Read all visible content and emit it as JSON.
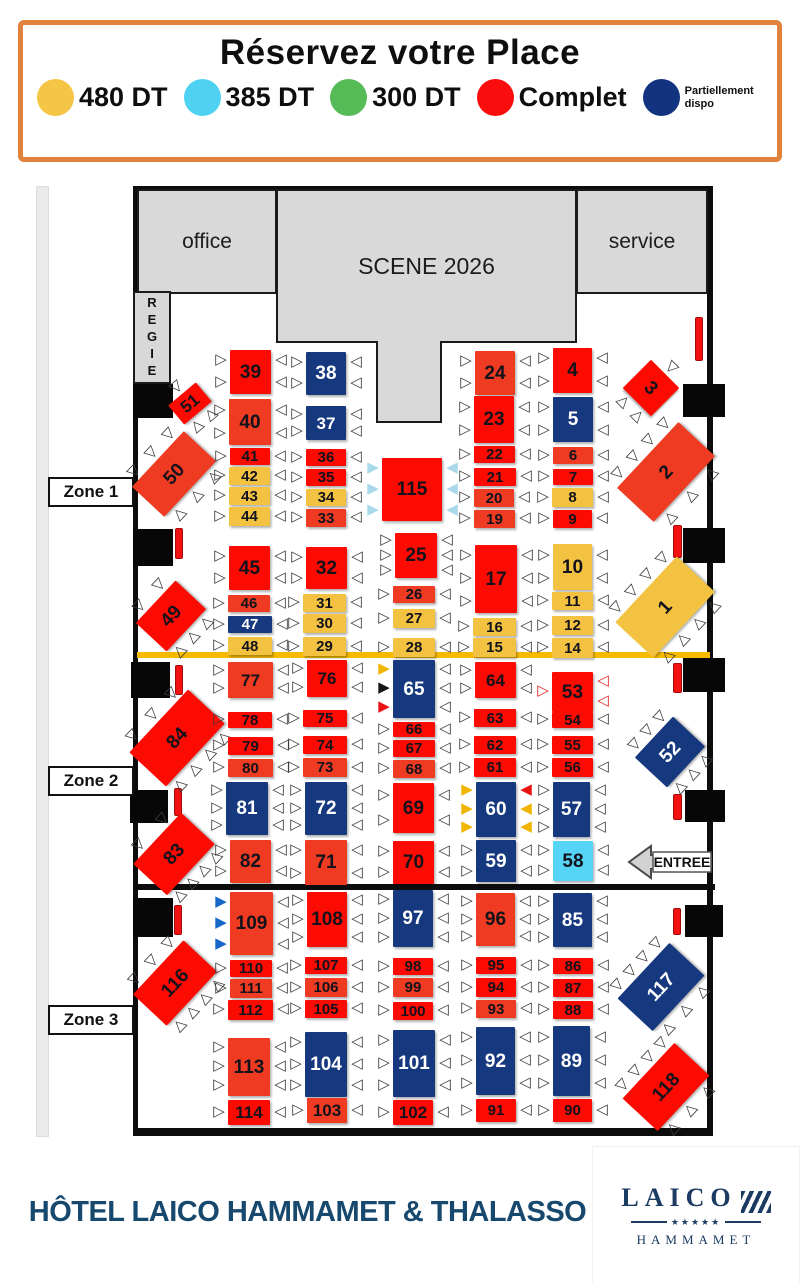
{
  "header": {
    "title": "Réservez votre Place",
    "legend": [
      {
        "name": "price-480",
        "label": "480 DT",
        "color": "#f5c546"
      },
      {
        "name": "price-385",
        "label": "385 DT",
        "color": "#4fd2f2"
      },
      {
        "name": "price-300",
        "label": "300 DT",
        "color": "#54bb57"
      },
      {
        "name": "complet",
        "label": "Complet",
        "color": "#fb0d0d"
      },
      {
        "name": "partiellement-dispo",
        "label": "Partiellement dispo",
        "color": "#12337f",
        "small": true
      }
    ]
  },
  "venue": {
    "office": "office",
    "scene": "SCENE 2026",
    "service": "service",
    "regie": "REGIE",
    "entree": "ENTREE"
  },
  "zones": [
    {
      "label": "Zone 1",
      "x": 48,
      "y": 477
    },
    {
      "label": "Zone 2",
      "x": 48,
      "y": 766
    },
    {
      "label": "Zone 3",
      "x": 48,
      "y": 1005
    }
  ],
  "palette": {
    "R": "#fb0b02",
    "O": "#ee3b21",
    "Y": "#f2c240",
    "B": "#16387f",
    "C": "#55d4f5",
    "chair_outline": "#3c3c3c",
    "chair_red_outline": "#e32222",
    "chair_cyan": "#a9d8ea",
    "chair_yellow": "#f1b400",
    "chair_black": "#161616",
    "chair_red": "#ea1313",
    "chair_blue": "#1767c9",
    "separator_yellow": "#f6bb00",
    "separator_black": "#0d0d0d"
  },
  "structure": {
    "blocks": [
      [
        133,
        384,
        40,
        34
      ],
      [
        133,
        529,
        40,
        37
      ],
      [
        131,
        662,
        39,
        36
      ],
      [
        130,
        790,
        38,
        33
      ],
      [
        133,
        898,
        40,
        39
      ],
      [
        683,
        384,
        42,
        33
      ],
      [
        683,
        528,
        42,
        35
      ],
      [
        683,
        658,
        42,
        34
      ],
      [
        685,
        790,
        40,
        32
      ],
      [
        685,
        905,
        38,
        32
      ]
    ],
    "bars": [
      [
        175,
        528,
        8,
        31
      ],
      [
        175,
        665,
        8,
        30
      ],
      [
        174,
        788,
        8,
        28
      ],
      [
        174,
        905,
        8,
        30
      ],
      [
        695,
        317,
        8,
        44
      ],
      [
        673,
        525,
        9,
        33
      ],
      [
        673,
        663,
        9,
        30
      ],
      [
        673,
        794,
        9,
        26
      ],
      [
        673,
        908,
        8,
        27
      ]
    ],
    "lines": [
      {
        "x": 137,
        "y": 652,
        "w": 573,
        "h": 6,
        "color": "#f6bb00",
        "name": "zone1-2-separator"
      },
      {
        "x": 137,
        "y": 884,
        "w": 578,
        "h": 6,
        "color": "#0d0d0d",
        "name": "zone2-3-separator"
      }
    ]
  },
  "tables": [
    [
      "39",
      230,
      350,
      41,
      44,
      "R",
      "ww",
      "ww",
      0
    ],
    [
      "38",
      306,
      352,
      40,
      43,
      "B",
      "ww",
      "ww",
      0
    ],
    [
      "51",
      172,
      391,
      36,
      25,
      "R",
      "w",
      "ww",
      -40
    ],
    [
      "40",
      229,
      399,
      42,
      46,
      "O",
      "ww",
      "ww",
      0
    ],
    [
      "37",
      306,
      406,
      40,
      34,
      "B",
      "ww",
      "ww",
      0
    ],
    [
      "50",
      136,
      452,
      76,
      44,
      "O",
      "www",
      "www",
      -47
    ],
    [
      "41",
      230,
      448,
      40,
      17,
      "R",
      "w",
      "w",
      0
    ],
    [
      "36",
      306,
      449,
      40,
      17,
      "R",
      "w",
      "w",
      0
    ],
    [
      "42",
      229,
      467,
      41,
      18,
      "Y",
      "w",
      "w",
      0
    ],
    [
      "35",
      306,
      469,
      40,
      17,
      "R",
      "w",
      "w",
      0
    ],
    [
      "43",
      229,
      487,
      41,
      18,
      "Y",
      "w",
      "w",
      0
    ],
    [
      "34",
      306,
      489,
      40,
      17,
      "Y",
      "w",
      "w",
      0
    ],
    [
      "44",
      229,
      507,
      41,
      19,
      "Y",
      "w",
      "w",
      0
    ],
    [
      "33",
      306,
      509,
      40,
      18,
      "O",
      "w",
      "w",
      0
    ],
    [
      "115",
      382,
      458,
      60,
      63,
      "R",
      "ccc",
      "ccc",
      0
    ],
    [
      "24",
      475,
      351,
      40,
      44,
      "O",
      "ww",
      "ww",
      0
    ],
    [
      "4",
      553,
      348,
      39,
      45,
      "R",
      "ww",
      "ww",
      0
    ],
    [
      "23",
      474,
      396,
      40,
      47,
      "R",
      "ww",
      "ww",
      0
    ],
    [
      "5",
      553,
      397,
      40,
      45,
      "B",
      "ww",
      "ww",
      0
    ],
    [
      "3",
      631,
      368,
      40,
      40,
      "R",
      "w",
      "ww",
      45
    ],
    [
      "22",
      474,
      446,
      41,
      17,
      "R",
      "w",
      "w",
      0
    ],
    [
      "6",
      553,
      447,
      40,
      17,
      "O",
      "w",
      "w",
      0
    ],
    [
      "21",
      474,
      468,
      42,
      18,
      "R",
      "w",
      "w",
      0
    ],
    [
      "7",
      553,
      469,
      40,
      16,
      "R",
      "w",
      "w",
      0
    ],
    [
      "20",
      474,
      489,
      40,
      18,
      "O",
      "w",
      "w",
      0
    ],
    [
      "8",
      552,
      488,
      41,
      19,
      "Y",
      "w",
      "w",
      0
    ],
    [
      "19",
      474,
      510,
      41,
      18,
      "O",
      "w",
      "w",
      0
    ],
    [
      "9",
      553,
      510,
      39,
      18,
      "R",
      "w",
      "w",
      0
    ],
    [
      "2",
      621,
      447,
      90,
      50,
      "O",
      "wwww",
      "www",
      -47
    ],
    [
      "45",
      229,
      546,
      41,
      44,
      "R",
      "ww",
      "ww",
      0
    ],
    [
      "32",
      306,
      547,
      41,
      42,
      "R",
      "ww",
      "ww",
      0
    ],
    [
      "25",
      395,
      533,
      42,
      45,
      "R",
      "www",
      "www",
      0
    ],
    [
      "17",
      475,
      545,
      42,
      68,
      "R",
      "www",
      "www",
      0
    ],
    [
      "10",
      553,
      544,
      39,
      46,
      "Y",
      "ww",
      "ww",
      0
    ],
    [
      "49",
      142,
      595,
      58,
      42,
      "R",
      "ww",
      "www",
      -47
    ],
    [
      "46",
      228,
      595,
      42,
      17,
      "O",
      "w",
      "w",
      0
    ],
    [
      "31",
      303,
      594,
      43,
      18,
      "Y",
      "w",
      "w",
      0
    ],
    [
      "26",
      393,
      586,
      42,
      17,
      "O",
      "w",
      "w",
      0
    ],
    [
      "11",
      552,
      592,
      41,
      18,
      "Y",
      "w",
      "w",
      0
    ],
    [
      "47",
      228,
      616,
      44,
      17,
      "B",
      "w",
      "w",
      0
    ],
    [
      "30",
      303,
      614,
      43,
      19,
      "Y",
      "w",
      "w",
      0
    ],
    [
      "27",
      393,
      609,
      42,
      19,
      "Y",
      "w",
      "w",
      0
    ],
    [
      "16",
      473,
      618,
      43,
      18,
      "Y",
      "w",
      "w",
      0
    ],
    [
      "12",
      552,
      616,
      41,
      19,
      "Y",
      "w",
      "w",
      0
    ],
    [
      "48",
      228,
      637,
      44,
      18,
      "Y",
      "w",
      "w",
      0
    ],
    [
      "29",
      303,
      637,
      43,
      19,
      "Y",
      "w",
      "w",
      0
    ],
    [
      "28",
      393,
      638,
      42,
      19,
      "Y",
      "w",
      "w",
      0
    ],
    [
      "15",
      473,
      638,
      43,
      19,
      "Y",
      "w",
      "w",
      0
    ],
    [
      "14",
      552,
      638,
      41,
      20,
      "Y",
      "w",
      "w",
      0
    ],
    [
      "1",
      620,
      581,
      90,
      52,
      "Y",
      "wwww",
      "wwww",
      -47
    ],
    [
      "77",
      228,
      662,
      45,
      36,
      "O",
      "ww",
      "ww",
      0
    ],
    [
      "76",
      307,
      660,
      40,
      37,
      "R",
      "ww",
      "ww",
      0
    ],
    [
      "65",
      393,
      660,
      42,
      58,
      "B",
      "ykr",
      "www",
      0
    ],
    [
      "64",
      475,
      662,
      41,
      36,
      "R",
      "ww",
      "ww",
      0
    ],
    [
      "53",
      552,
      672,
      41,
      40,
      "R",
      "o",
      "oo",
      0
    ],
    [
      "84",
      134,
      713,
      86,
      50,
      "R",
      "www",
      "wwww",
      -47
    ],
    [
      "78",
      228,
      712,
      44,
      16,
      "R",
      "w",
      "w",
      0
    ],
    [
      "75",
      303,
      710,
      44,
      17,
      "R",
      "w",
      "w",
      0
    ],
    [
      "66",
      393,
      722,
      42,
      15,
      "R",
      "w",
      "w",
      0
    ],
    [
      "63",
      474,
      709,
      42,
      18,
      "R",
      "w",
      "w",
      0
    ],
    [
      "54",
      552,
      712,
      41,
      16,
      "R",
      "w",
      "w",
      0
    ],
    [
      "79",
      228,
      737,
      45,
      18,
      "R",
      "w",
      "w",
      0
    ],
    [
      "74",
      303,
      736,
      44,
      18,
      "R",
      "w",
      "w",
      0
    ],
    [
      "67",
      393,
      740,
      42,
      17,
      "R",
      "w",
      "w",
      0
    ],
    [
      "62",
      474,
      736,
      42,
      18,
      "R",
      "w",
      "w",
      0
    ],
    [
      "55",
      552,
      736,
      41,
      18,
      "R",
      "w",
      "w",
      0
    ],
    [
      "80",
      228,
      759,
      45,
      18,
      "O",
      "w",
      "w",
      0
    ],
    [
      "73",
      303,
      758,
      44,
      19,
      "O",
      "w",
      "w",
      0
    ],
    [
      "68",
      393,
      760,
      42,
      18,
      "O",
      "w",
      "w",
      0
    ],
    [
      "61",
      474,
      758,
      42,
      19,
      "R",
      "w",
      "w",
      0
    ],
    [
      "56",
      552,
      758,
      41,
      19,
      "R",
      "w",
      "w",
      0
    ],
    [
      "52",
      642,
      730,
      56,
      44,
      "B",
      "www",
      "www",
      -47
    ],
    [
      "81",
      226,
      782,
      42,
      53,
      "B",
      "www",
      "www",
      0
    ],
    [
      "72",
      305,
      782,
      42,
      53,
      "B",
      "www",
      "www",
      0
    ],
    [
      "69",
      393,
      783,
      41,
      50,
      "R",
      "ww",
      "ww",
      0
    ],
    [
      "60",
      476,
      782,
      40,
      55,
      "B",
      "yyy",
      "ryy",
      0
    ],
    [
      "57",
      553,
      782,
      37,
      55,
      "B",
      "www",
      "www",
      0
    ],
    [
      "83",
      139,
      831,
      70,
      46,
      "R",
      "ww",
      "wwww",
      -47
    ],
    [
      "82",
      230,
      840,
      41,
      43,
      "O",
      "ww",
      "ww",
      0
    ],
    [
      "71",
      305,
      840,
      42,
      45,
      "O",
      "ww",
      "ww",
      0
    ],
    [
      "70",
      393,
      841,
      41,
      43,
      "R",
      "ww",
      "ww",
      0
    ],
    [
      "59",
      476,
      840,
      40,
      42,
      "B",
      "ww",
      "ww",
      0
    ],
    [
      "58",
      553,
      841,
      40,
      40,
      "C",
      "ww",
      "ww",
      0
    ],
    [
      "109",
      230,
      892,
      43,
      63,
      "O",
      "bbb",
      "www",
      0
    ],
    [
      "108",
      307,
      892,
      40,
      55,
      "R",
      "www",
      "www",
      0
    ],
    [
      "97",
      393,
      890,
      40,
      57,
      "B",
      "www",
      "www",
      0
    ],
    [
      "96",
      476,
      893,
      39,
      53,
      "O",
      "www",
      "www",
      0
    ],
    [
      "85",
      553,
      893,
      39,
      54,
      "B",
      "www",
      "www",
      0
    ],
    [
      "116",
      138,
      960,
      74,
      46,
      "R",
      "www",
      "wwww",
      -47
    ],
    [
      "110",
      230,
      960,
      42,
      17,
      "R",
      "w",
      "w",
      0
    ],
    [
      "107",
      305,
      957,
      42,
      17,
      "R",
      "w",
      "w",
      0
    ],
    [
      "98",
      393,
      958,
      40,
      17,
      "R",
      "w",
      "w",
      0
    ],
    [
      "95",
      476,
      957,
      40,
      17,
      "R",
      "w",
      "w",
      0
    ],
    [
      "86",
      553,
      958,
      40,
      16,
      "R",
      "w",
      "w",
      0
    ],
    [
      "111",
      230,
      979,
      42,
      19,
      "O",
      "w",
      "w",
      0
    ],
    [
      "106",
      305,
      978,
      42,
      19,
      "O",
      "w",
      "w",
      0
    ],
    [
      "99",
      393,
      978,
      40,
      19,
      "O",
      "w",
      "w",
      0
    ],
    [
      "94",
      476,
      978,
      40,
      19,
      "R",
      "w",
      "w",
      0
    ],
    [
      "87",
      553,
      979,
      40,
      18,
      "R",
      "w",
      "w",
      0
    ],
    [
      "112",
      228,
      1000,
      45,
      20,
      "R",
      "w",
      "w",
      0
    ],
    [
      "105",
      305,
      1000,
      42,
      18,
      "R",
      "w",
      "w",
      0
    ],
    [
      "100",
      393,
      1002,
      40,
      18,
      "R",
      "w",
      "w",
      0
    ],
    [
      "93",
      476,
      1000,
      40,
      18,
      "O",
      "w",
      "w",
      0
    ],
    [
      "88",
      553,
      1001,
      40,
      18,
      "R",
      "w",
      "w",
      0
    ],
    [
      "117",
      623,
      963,
      76,
      48,
      "B",
      "wwww",
      "www",
      -47
    ],
    [
      "113",
      228,
      1038,
      42,
      58,
      "O",
      "www",
      "www",
      0
    ],
    [
      "104",
      305,
      1032,
      42,
      65,
      "B",
      "www",
      "www",
      0
    ],
    [
      "101",
      393,
      1030,
      42,
      67,
      "B",
      "www",
      "www",
      0
    ],
    [
      "92",
      476,
      1027,
      39,
      68,
      "B",
      "www",
      "www",
      0
    ],
    [
      "89",
      553,
      1026,
      37,
      70,
      "B",
      "www",
      "www",
      0
    ],
    [
      "114",
      228,
      1100,
      42,
      25,
      "R",
      "w",
      "w",
      0
    ],
    [
      "103",
      307,
      1098,
      40,
      25,
      "O",
      "w",
      "w",
      0
    ],
    [
      "102",
      393,
      1100,
      40,
      25,
      "R",
      "w",
      "w",
      0
    ],
    [
      "91",
      476,
      1099,
      40,
      23,
      "R",
      "w",
      "w",
      0
    ],
    [
      "90",
      553,
      1099,
      39,
      23,
      "R",
      "w",
      "w",
      0
    ],
    [
      "118",
      628,
      1063,
      76,
      48,
      "R",
      "wwww",
      "www",
      -47
    ]
  ],
  "footer": {
    "hotel": "HÔTEL LAICO HAMMAMET & THALASSO",
    "logo": {
      "name": "LAICO",
      "stars": "★★★★★",
      "sub": "HAMMAMET"
    }
  }
}
